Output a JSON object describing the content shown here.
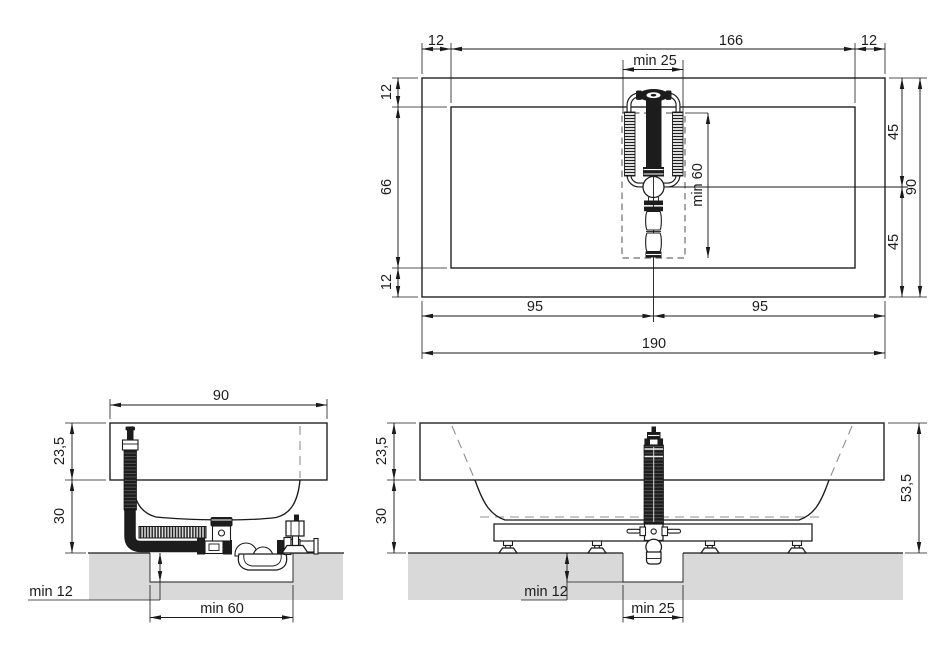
{
  "plan": {
    "offset_left": "12",
    "inner_length": "166",
    "offset_right": "12",
    "drain_recess_width": "min 25",
    "offset_top": "12",
    "inner_width": "66",
    "offset_bottom": "12",
    "half_width_upper": "45",
    "half_width_lower": "45",
    "total_width": "90",
    "drain_recess_length": "min 60",
    "half_length_left": "95",
    "half_length_right": "95",
    "total_length": "190"
  },
  "end_view": {
    "total_width": "90",
    "rim_height": "23,5",
    "base_height": "30",
    "recess_depth": "min 12",
    "recess_length": "min 60"
  },
  "side_view": {
    "rim_height": "23,5",
    "base_height": "30",
    "total_height": "53,5",
    "recess_depth": "min 12",
    "recess_width": "min 25"
  },
  "colors": {
    "line": "#1a1a1a",
    "floor": "#d9d9d9",
    "pipe": "#1c1c1c",
    "background": "#ffffff"
  }
}
